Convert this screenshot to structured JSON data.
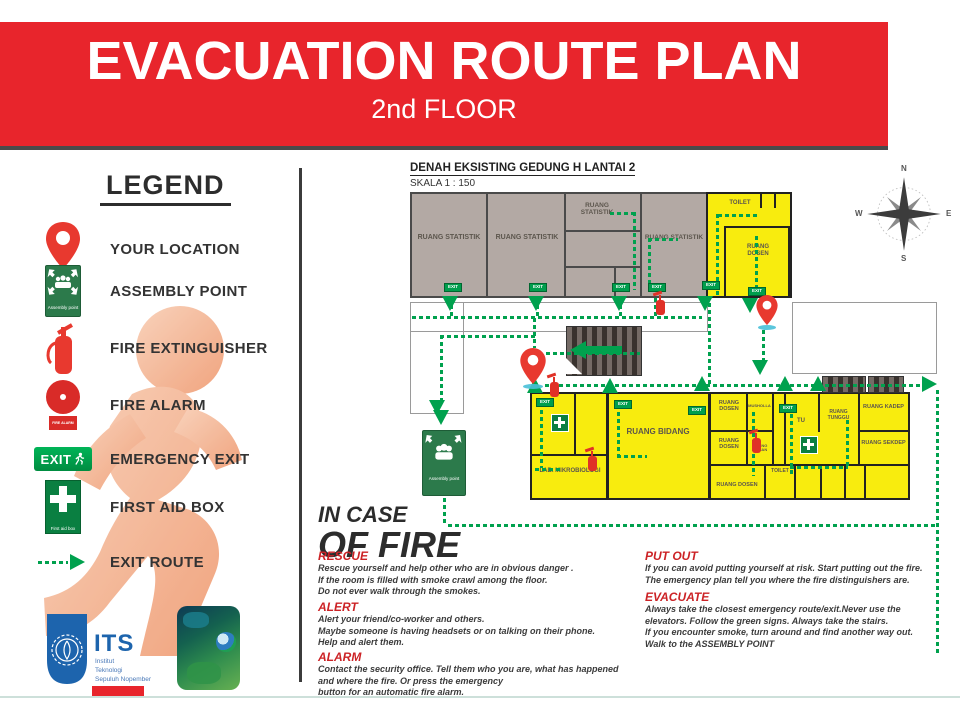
{
  "header": {
    "title": "EVACUATION ROUTE PLAN",
    "subtitle": "2nd FLOOR"
  },
  "legend": {
    "title": "LEGEND",
    "items": [
      {
        "icon": "location-pin-icon",
        "label": "YOUR LOCATION"
      },
      {
        "icon": "assembly-point-icon",
        "label": "ASSEMBLY POINT"
      },
      {
        "icon": "fire-extinguisher-icon",
        "label": "FIRE EXTINGUISHER"
      },
      {
        "icon": "fire-alarm-icon",
        "label": "FIRE ALARM"
      },
      {
        "icon": "emergency-exit-icon",
        "label": "EMERGENCY EXIT"
      },
      {
        "icon": "first-aid-icon",
        "label": "FIRST AID BOX"
      },
      {
        "icon": "exit-route-icon",
        "label": "EXIT ROUTE"
      }
    ],
    "assembly_sign_text": "Assembly point",
    "exit_sign_text": "EXIT",
    "first_aid_sign_text": "First aid box",
    "fire_alarm_sign_text": "FIRE ALARM"
  },
  "plan": {
    "title": "DENAH EKSISTING GEDUNG H LANTAI 2",
    "scale": "SKALA 1 : 150",
    "exit_label": "EXIT",
    "assembly_label": "Assembly point",
    "compass": {
      "north": "N",
      "south": "S",
      "east": "E",
      "west": "W"
    },
    "rooms": [
      {
        "name": "RUANG STATISTIK"
      },
      {
        "name": "RUANG STATISTIK"
      },
      {
        "name": "RUANG STATISTIK"
      },
      {
        "name": "RUANG STATISTIK"
      },
      {
        "name": "TOILET"
      },
      {
        "name": "RUANG DOSEN"
      },
      {
        "name": "LAB. MIKROBIOLOGI"
      },
      {
        "name": "RUANG BIDANG"
      },
      {
        "name": "RUANG DOSEN"
      },
      {
        "name": "MUSHOLLA"
      },
      {
        "name": "TU"
      },
      {
        "name": "RUANG TUNGGU"
      },
      {
        "name": "RUANG KADEP"
      },
      {
        "name": "RUANG DOSEN"
      },
      {
        "name": "RUANG BAHAN"
      },
      {
        "name": "RUANG SEKDEP"
      },
      {
        "name": "TOILET"
      },
      {
        "name": "RUANG DOSEN"
      }
    ]
  },
  "instructions": {
    "heading_line1": "IN CASE",
    "heading_line2": "OF FIRE",
    "sections": [
      {
        "title": "RESCUE",
        "body": "Rescue yourself and help other who are in obvious danger .\nIf the room is filled with smoke crawl among the floor.\nDo not ever walk through the smokes."
      },
      {
        "title": "ALERT",
        "body": "Alert your friend/co-worker and others.\nMaybe someone is having headsets or on talking on their phone.\nHelp and alert them."
      },
      {
        "title": "ALARM",
        "body": "Contact the security office. Tell them who you are, what has happened\nand where the fire. Or press the emergency\nbutton for an automatic fire alarm."
      },
      {
        "title": "PUT OUT",
        "body": "If you can avoid putting yourself at risk. Start putting out the fire.\nThe emergency plan tell you where the fire distinguishers are."
      },
      {
        "title": "EVACUATE",
        "body": "Always take the closest emergency route/exit.Never use the\nelevators. Follow the green signs. Always take the stairs.\nIf you encounter smoke, turn around and find another way out.\nWalk to the ASSEMBLY POINT"
      }
    ]
  },
  "footer": {
    "its_acronym": "ITS",
    "its_name_lines": [
      "Institut",
      "Teknologi",
      "Sepuluh Nopember"
    ]
  },
  "colors": {
    "banner_red": "#e8252c",
    "route_green": "#00a14e",
    "room_yellow": "#f8ec0e",
    "room_gray": "#b3a9a4",
    "heading_red": "#cc2326",
    "its_blue": "#1d64ad"
  }
}
